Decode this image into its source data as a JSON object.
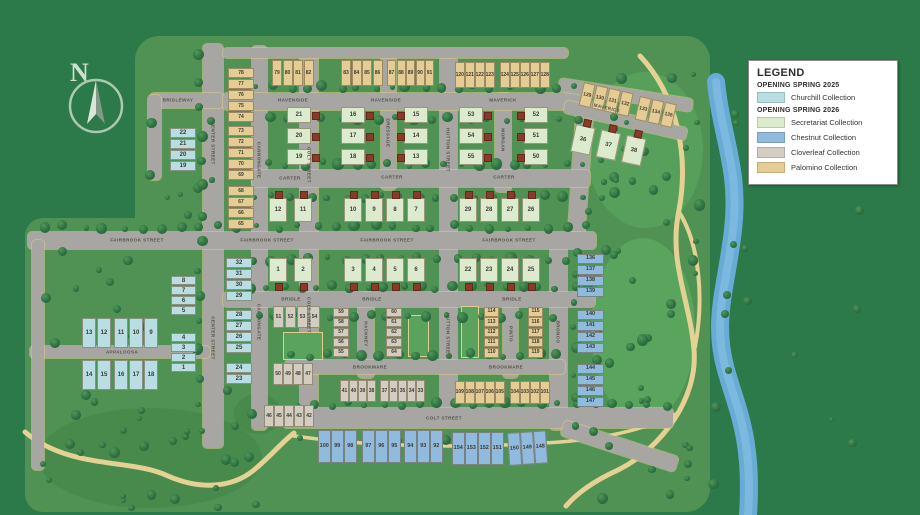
{
  "legend": {
    "title": "LEGEND",
    "groups": [
      {
        "heading": "OPENING SPRING 2025",
        "items": [
          {
            "label": "Churchill Collection",
            "color": "#b8dde2"
          }
        ]
      },
      {
        "heading": "OPENING SPRING 2026",
        "items": [
          {
            "label": "Secretariat Collection",
            "color": "#dcebce"
          },
          {
            "label": "Chestnut Collection",
            "color": "#90bade"
          },
          {
            "label": "Cloverleaf Collection",
            "color": "#d2ccc1"
          },
          {
            "label": "Palomino Collection",
            "color": "#e5cc95"
          }
        ]
      }
    ]
  },
  "compass": {
    "label": "N"
  },
  "map": {
    "street_labels": [
      {
        "text": "BRIDLEWAY",
        "x": 178,
        "y": 100,
        "rot": 0
      },
      {
        "text": "CENTER STREET",
        "x": 213,
        "y": 143,
        "rot": 90
      },
      {
        "text": "CENTER STREET",
        "x": 213,
        "y": 338,
        "rot": 90
      },
      {
        "text": "CANNONGATE",
        "x": 259,
        "y": 160,
        "rot": 90
      },
      {
        "text": "CANNONGATE",
        "x": 259,
        "y": 322,
        "rot": 90
      },
      {
        "text": "COLT STREET",
        "x": 309,
        "y": 165,
        "rot": 90
      },
      {
        "text": "COLT STREET",
        "x": 309,
        "y": 315,
        "rot": 90
      },
      {
        "text": "DRESSAGE",
        "x": 388,
        "y": 133,
        "rot": 90
      },
      {
        "text": "HUTTON STREET",
        "x": 448,
        "y": 150,
        "rot": 90
      },
      {
        "text": "HUTTON STREET",
        "x": 448,
        "y": 335,
        "rot": 90
      },
      {
        "text": "MORGAN",
        "x": 503,
        "y": 140,
        "rot": 90
      },
      {
        "text": "PINTO",
        "x": 511,
        "y": 334,
        "rot": 90
      },
      {
        "text": "HACKNEY",
        "x": 366,
        "y": 334,
        "rot": 90
      },
      {
        "text": "BRONCO",
        "x": 558,
        "y": 332,
        "rot": 90
      },
      {
        "text": "HAVENSIDE",
        "x": 293,
        "y": 100,
        "rot": 0
      },
      {
        "text": "HAVENSIDE",
        "x": 386,
        "y": 100,
        "rot": 0
      },
      {
        "text": "MAVERICK",
        "x": 503,
        "y": 100,
        "rot": 0
      },
      {
        "text": "MAVERICK",
        "x": 607,
        "y": 108,
        "rot": 13
      },
      {
        "text": "CARTER",
        "x": 290,
        "y": 178,
        "rot": 0
      },
      {
        "text": "CARTER",
        "x": 392,
        "y": 177,
        "rot": 0
      },
      {
        "text": "CARTER",
        "x": 504,
        "y": 177,
        "rot": 0
      },
      {
        "text": "FAIRBROOK STREET",
        "x": 137,
        "y": 240,
        "rot": 0
      },
      {
        "text": "FAIRBROOK STREET",
        "x": 267,
        "y": 240,
        "rot": 0
      },
      {
        "text": "FAIRBROOK STREET",
        "x": 387,
        "y": 240,
        "rot": 0
      },
      {
        "text": "FAIRBROOK STREET",
        "x": 509,
        "y": 240,
        "rot": 0
      },
      {
        "text": "BRIDLE",
        "x": 291,
        "y": 299,
        "rot": 0
      },
      {
        "text": "BRIDLE",
        "x": 372,
        "y": 299,
        "rot": 0
      },
      {
        "text": "BRIDLE",
        "x": 512,
        "y": 299,
        "rot": 0
      },
      {
        "text": "BROOKMARE",
        "x": 370,
        "y": 367,
        "rot": 0
      },
      {
        "text": "BROOKMARE",
        "x": 506,
        "y": 367,
        "rot": 0
      },
      {
        "text": "APPALOOSA",
        "x": 122,
        "y": 352,
        "rot": 0
      },
      {
        "text": "COLT STREET",
        "x": 444,
        "y": 418,
        "rot": 0
      }
    ],
    "lot_groups": [
      {
        "collection": "churchill",
        "x": 170,
        "y": 128,
        "dir": "col",
        "w": 26,
        "h": 10,
        "gap": 1,
        "fs": 6,
        "lots": [
          "22",
          "21",
          "20",
          "19"
        ]
      },
      {
        "collection": "churchill",
        "x": 226,
        "y": 258,
        "dir": "col",
        "w": 26,
        "h": 10,
        "gap": 1,
        "fs": 6,
        "lots": [
          "32",
          "31",
          "30",
          "29"
        ]
      },
      {
        "collection": "churchill",
        "x": 226,
        "y": 310,
        "dir": "col",
        "w": 26,
        "h": 10,
        "gap": 1,
        "fs": 6,
        "lots": [
          "28",
          "27",
          "26",
          "25"
        ]
      },
      {
        "collection": "churchill",
        "x": 226,
        "y": 363,
        "dir": "col",
        "w": 26,
        "h": 10,
        "gap": 1,
        "fs": 6,
        "lots": [
          "24",
          "23"
        ]
      },
      {
        "collection": "churchill",
        "x": 171,
        "y": 276,
        "dir": "col",
        "w": 25,
        "h": 9,
        "gap": 1,
        "fs": 6,
        "lots": [
          "8",
          "7",
          "6",
          "5"
        ]
      },
      {
        "collection": "churchill",
        "x": 171,
        "y": 333,
        "dir": "col",
        "w": 25,
        "h": 9,
        "gap": 1,
        "fs": 6,
        "lots": [
          "4",
          "3",
          "2",
          "1"
        ]
      },
      {
        "collection": "churchill",
        "x": 82,
        "y": 318,
        "dir": "row",
        "w": 14,
        "h": 30,
        "gap": 1,
        "fs": 6,
        "lots": [
          "13",
          "12"
        ]
      },
      {
        "collection": "churchill",
        "x": 114,
        "y": 318,
        "dir": "row",
        "w": 14,
        "h": 30,
        "gap": 1,
        "fs": 6,
        "lots": [
          "11",
          "10",
          "9"
        ]
      },
      {
        "collection": "churchill",
        "x": 82,
        "y": 360,
        "dir": "row",
        "w": 14,
        "h": 30,
        "gap": 1,
        "fs": 6,
        "lots": [
          "14",
          "15"
        ]
      },
      {
        "collection": "churchill",
        "x": 114,
        "y": 360,
        "dir": "row",
        "w": 14,
        "h": 30,
        "gap": 1,
        "fs": 6,
        "lots": [
          "16",
          "17",
          "18"
        ]
      },
      {
        "collection": "secretariat",
        "x": 287,
        "y": 107,
        "dir": "col",
        "w": 24,
        "h": 16,
        "gap": 5,
        "fs": 6,
        "garage": "right",
        "lots": [
          "21",
          "20",
          "19"
        ]
      },
      {
        "collection": "secretariat",
        "x": 341,
        "y": 107,
        "dir": "col",
        "w": 24,
        "h": 16,
        "gap": 5,
        "fs": 6,
        "garage": "right",
        "lots": [
          "16",
          "17",
          "18"
        ]
      },
      {
        "collection": "secretariat",
        "x": 404,
        "y": 107,
        "dir": "col",
        "w": 24,
        "h": 16,
        "gap": 5,
        "fs": 6,
        "garage": "left",
        "lots": [
          "15",
          "14",
          "13"
        ]
      },
      {
        "collection": "secretariat",
        "x": 459,
        "y": 107,
        "dir": "col",
        "w": 24,
        "h": 16,
        "gap": 5,
        "fs": 6,
        "garage": "right",
        "lots": [
          "53",
          "54",
          "55"
        ]
      },
      {
        "collection": "secretariat",
        "x": 524,
        "y": 107,
        "dir": "col",
        "w": 24,
        "h": 16,
        "gap": 5,
        "fs": 6,
        "garage": "left",
        "lots": [
          "52",
          "51",
          "50"
        ]
      },
      {
        "collection": "secretariat",
        "x": 269,
        "y": 198,
        "dir": "row",
        "w": 18,
        "h": 24,
        "gap": 7,
        "fs": 6,
        "garage": "top",
        "lots": [
          "12",
          "11"
        ]
      },
      {
        "collection": "secretariat",
        "x": 344,
        "y": 198,
        "dir": "row",
        "w": 18,
        "h": 24,
        "gap": 3,
        "fs": 6,
        "garage": "top",
        "lots": [
          "10",
          "9",
          "8",
          "7"
        ]
      },
      {
        "collection": "secretariat",
        "x": 459,
        "y": 198,
        "dir": "row",
        "w": 18,
        "h": 24,
        "gap": 3,
        "fs": 6,
        "garage": "top",
        "lots": [
          "29",
          "28",
          "27",
          "26"
        ]
      },
      {
        "collection": "secretariat",
        "x": 269,
        "y": 258,
        "dir": "row",
        "w": 18,
        "h": 24,
        "gap": 7,
        "fs": 6,
        "garage": "bottom",
        "lots": [
          "1",
          "2"
        ]
      },
      {
        "collection": "secretariat",
        "x": 344,
        "y": 258,
        "dir": "row",
        "w": 18,
        "h": 24,
        "gap": 3,
        "fs": 6,
        "garage": "bottom",
        "lots": [
          "3",
          "4",
          "5",
          "6"
        ]
      },
      {
        "collection": "secretariat",
        "x": 459,
        "y": 258,
        "dir": "row",
        "w": 18,
        "h": 24,
        "gap": 3,
        "fs": 6,
        "garage": "bottom",
        "lots": [
          "22",
          "23",
          "24",
          "25"
        ]
      },
      {
        "collection": "secretariat",
        "x": 576,
        "y": 124,
        "dir": "row",
        "w": 20,
        "h": 28,
        "gap": 6,
        "fs": 6,
        "rot": 12,
        "garage": "top",
        "lots": [
          "36",
          "37",
          "38"
        ]
      },
      {
        "collection": "cloverleaf",
        "x": 273,
        "y": 306,
        "dir": "row",
        "w": 11,
        "h": 22,
        "gap": 1,
        "fs": 5,
        "lots": [
          "51",
          "52",
          "53",
          "54"
        ]
      },
      {
        "collection": "cloverleaf",
        "x": 273,
        "y": 363,
        "dir": "row",
        "w": 10,
        "h": 22,
        "gap": 0,
        "fs": 5,
        "lots": [
          "50",
          "49",
          "48",
          "47"
        ]
      },
      {
        "collection": "cloverleaf",
        "x": 264,
        "y": 405,
        "dir": "row",
        "w": 10,
        "h": 22,
        "gap": 0,
        "fs": 5,
        "lots": [
          "46",
          "45",
          "44",
          "43",
          "42"
        ]
      },
      {
        "collection": "cloverleaf",
        "x": 333,
        "y": 308,
        "dir": "col",
        "w": 16,
        "h": 9,
        "gap": 1,
        "fs": 5,
        "lots": [
          "59",
          "58",
          "57",
          "56",
          "55"
        ]
      },
      {
        "collection": "cloverleaf",
        "x": 386,
        "y": 308,
        "dir": "col",
        "w": 16,
        "h": 9,
        "gap": 1,
        "fs": 5,
        "lots": [
          "60",
          "61",
          "62",
          "63",
          "64"
        ]
      },
      {
        "collection": "cloverleaf",
        "x": 340,
        "y": 380,
        "dir": "row",
        "w": 9,
        "h": 22,
        "gap": 0,
        "fs": 5,
        "lots": [
          "41",
          "40",
          "39",
          "38"
        ]
      },
      {
        "collection": "cloverleaf",
        "x": 380,
        "y": 380,
        "dir": "row",
        "w": 9,
        "h": 22,
        "gap": 0,
        "fs": 5,
        "lots": [
          "37",
          "36",
          "35",
          "34",
          "33"
        ]
      },
      {
        "collection": "palomino",
        "x": 228,
        "y": 68,
        "dir": "col",
        "w": 26,
        "h": 10,
        "gap": 1,
        "fs": 5,
        "lots": [
          "78",
          "77",
          "76",
          "75",
          "74"
        ]
      },
      {
        "collection": "palomino",
        "x": 228,
        "y": 126,
        "dir": "col",
        "w": 26,
        "h": 10,
        "gap": 1,
        "fs": 5,
        "lots": [
          "73",
          "72",
          "71",
          "70",
          "69"
        ]
      },
      {
        "collection": "palomino",
        "x": 228,
        "y": 186,
        "dir": "col",
        "w": 26,
        "h": 10,
        "gap": 1,
        "fs": 5,
        "lots": [
          "68",
          "67",
          "66",
          "65"
        ]
      },
      {
        "collection": "palomino",
        "x": 272,
        "y": 60,
        "dir": "row",
        "w": 10,
        "h": 26,
        "gap": 0.5,
        "fs": 5,
        "lots": [
          "79",
          "80",
          "81",
          "82"
        ]
      },
      {
        "collection": "palomino",
        "x": 341,
        "y": 60,
        "dir": "row",
        "w": 10,
        "h": 26,
        "gap": 0.5,
        "fs": 5,
        "lots": [
          "83",
          "84",
          "85",
          "86"
        ]
      },
      {
        "collection": "palomino",
        "x": 387,
        "y": 60,
        "dir": "row",
        "w": 9,
        "h": 26,
        "gap": 0.5,
        "fs": 5,
        "lots": [
          "87",
          "88",
          "89",
          "90",
          "91"
        ]
      },
      {
        "collection": "palomino",
        "x": 455,
        "y": 62,
        "dir": "row",
        "w": 9.5,
        "h": 26,
        "gap": 0.5,
        "fs": 5,
        "lots": [
          "120",
          "121",
          "122",
          "123"
        ]
      },
      {
        "collection": "palomino",
        "x": 500,
        "y": 62,
        "dir": "row",
        "w": 9.5,
        "h": 26,
        "gap": 0.5,
        "fs": 5,
        "lots": [
          "124",
          "125",
          "126",
          "127",
          "128"
        ]
      },
      {
        "collection": "palomino",
        "x": 584,
        "y": 82,
        "dir": "row",
        "w": 12,
        "h": 24,
        "gap": 1,
        "fs": 5,
        "rot": 13,
        "lots": [
          "129",
          "130",
          "131",
          "132"
        ]
      },
      {
        "collection": "palomino",
        "x": 640,
        "y": 96,
        "dir": "row",
        "w": 12,
        "h": 24,
        "gap": 1,
        "fs": 5,
        "rot": 13,
        "lots": [
          "133",
          "134",
          "135"
        ]
      },
      {
        "collection": "palomino",
        "x": 484,
        "y": 307,
        "dir": "col",
        "w": 15,
        "h": 9.5,
        "gap": 0.8,
        "fs": 5,
        "lots": [
          "114",
          "113",
          "112",
          "111",
          "110"
        ]
      },
      {
        "collection": "palomino",
        "x": 528,
        "y": 307,
        "dir": "col",
        "w": 15,
        "h": 9.5,
        "gap": 0.8,
        "fs": 5,
        "lots": [
          "115",
          "116",
          "117",
          "118",
          "119"
        ]
      },
      {
        "collection": "palomino",
        "x": 455,
        "y": 381,
        "dir": "row",
        "w": 9.5,
        "h": 23,
        "gap": 0.5,
        "fs": 5,
        "lots": [
          "109",
          "108",
          "107",
          "106",
          "105"
        ]
      },
      {
        "collection": "palomino",
        "x": 510,
        "y": 381,
        "dir": "row",
        "w": 9.5,
        "h": 23,
        "gap": 0.5,
        "fs": 5,
        "lots": [
          "104",
          "103",
          "102",
          "101"
        ]
      },
      {
        "collection": "chestnut",
        "x": 577,
        "y": 254,
        "dir": "col",
        "w": 27,
        "h": 10,
        "gap": 1,
        "fs": 5.5,
        "lots": [
          "136",
          "137",
          "138",
          "139"
        ]
      },
      {
        "collection": "chestnut",
        "x": 577,
        "y": 310,
        "dir": "col",
        "w": 27,
        "h": 10,
        "gap": 1,
        "fs": 5.5,
        "lots": [
          "140",
          "141",
          "142",
          "143"
        ]
      },
      {
        "collection": "chestnut",
        "x": 577,
        "y": 364,
        "dir": "col",
        "w": 27,
        "h": 10,
        "gap": 1,
        "fs": 5.5,
        "lots": [
          "144",
          "145",
          "146",
          "147"
        ]
      },
      {
        "collection": "chestnut",
        "x": 318,
        "y": 430,
        "dir": "row",
        "w": 12.5,
        "h": 33,
        "gap": 0.5,
        "fs": 5.5,
        "lots": [
          "100",
          "99",
          "98"
        ]
      },
      {
        "collection": "chestnut",
        "x": 362,
        "y": 430,
        "dir": "row",
        "w": 12.5,
        "h": 33,
        "gap": 0.5,
        "fs": 5.5,
        "lots": [
          "97",
          "96",
          "95"
        ]
      },
      {
        "collection": "chestnut",
        "x": 404,
        "y": 430,
        "dir": "row",
        "w": 12.5,
        "h": 33,
        "gap": 0.5,
        "fs": 5.5,
        "lots": [
          "94",
          "93",
          "92"
        ]
      },
      {
        "collection": "chestnut",
        "x": 452,
        "y": 432,
        "dir": "row",
        "w": 12.5,
        "h": 33,
        "gap": 0.5,
        "fs": 5.5,
        "lots": [
          "154",
          "153",
          "152",
          "151"
        ]
      },
      {
        "collection": "chestnut",
        "x": 507,
        "y": 433,
        "dir": "row",
        "w": 12.5,
        "h": 33,
        "gap": 0.5,
        "fs": 5.5,
        "rot": -4,
        "lots": [
          "150",
          "149",
          "148"
        ]
      }
    ]
  }
}
